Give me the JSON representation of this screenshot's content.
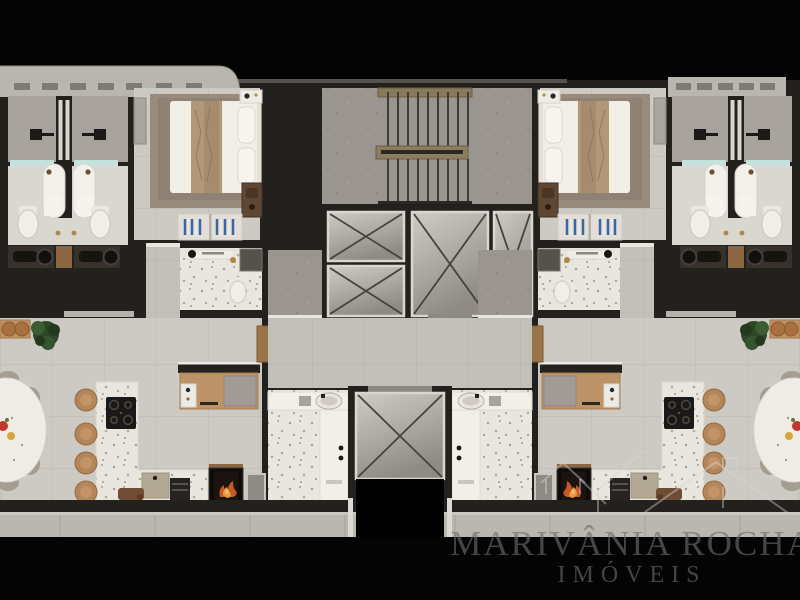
{
  "image_type": "3d-architectural-floor-plan-render",
  "watermark": {
    "line1": "MARIVÂNIA ROCHA",
    "line2": "IMÓVEIS"
  },
  "brand": {
    "logo": "double-house-outline"
  },
  "palette": {
    "background": "#000000",
    "wall": "#23211e",
    "floor_tile": "#cdc9c3",
    "floor_hall": "#c3bfb9",
    "terrazzo": "#e9e5df",
    "concrete": "#9a958f",
    "balcony_ledge": "#b9b5af",
    "elevator_floor_light": "#cbc7c1",
    "elevator_floor_dark": "#8f8a84",
    "wood": "#bf9265",
    "stool_wood": "#b3855b",
    "stair_wood": "#8a7a5c",
    "wardrobe": "#5f4833",
    "bed_blanket": "#b29876",
    "linen_white": "#f1eee8",
    "shower_glass": "#c3e1dd",
    "vanity_dark": "#38302a",
    "hanger_blue": "#3a67a0",
    "grill_fire": "#c85a28",
    "plant_green": "#2e4527",
    "chair_taupe": "#a69d91",
    "watermark_text": "rgba(112,110,107,0.62)"
  },
  "plan": {
    "core": {
      "features": [
        "staircase",
        "elevator-shaft-small-1",
        "elevator-shaft-small-2",
        "elevator-shaft-large",
        "elevator-shaft-side",
        "service-shaft",
        "entry-hall",
        "elevator-lobby"
      ]
    },
    "units": [
      {
        "id": "left-apartment",
        "rooms": [
          "bathroom-1",
          "bathroom-2",
          "bedroom",
          "ensuite-bathroom",
          "corridor",
          "living-dining",
          "kitchen",
          "laundry",
          "balcony"
        ],
        "fixtures": [
          "shower",
          "shower",
          "toilet",
          "toilet",
          "double-vanity",
          "double-bed",
          "nightstand",
          "wardrobe",
          "open-closet-blue-hangers",
          "desk",
          "kitchen-island",
          "cooktop",
          "kitchen-sink",
          "oven",
          "bar-stools",
          "oval-dining-table",
          "dining-chairs",
          "console-with-stools",
          "plant",
          "barbecue-grill",
          "laundry-basin",
          "louver-vents"
        ]
      },
      {
        "id": "right-apartment",
        "rooms": [
          "bathroom-1",
          "bathroom-2",
          "bedroom",
          "ensuite-bathroom",
          "corridor",
          "living-dining",
          "kitchen",
          "laundry",
          "balcony"
        ],
        "fixtures": [
          "shower",
          "shower",
          "toilet",
          "toilet",
          "double-vanity",
          "double-bed",
          "nightstand",
          "wardrobe",
          "open-closet-blue-hangers",
          "desk",
          "kitchen-island",
          "cooktop",
          "kitchen-sink",
          "oven",
          "bar-stools",
          "oval-dining-table",
          "dining-chairs",
          "console-with-stools",
          "plant",
          "barbecue-grill",
          "laundry-basin",
          "louver-vents"
        ]
      }
    ]
  }
}
